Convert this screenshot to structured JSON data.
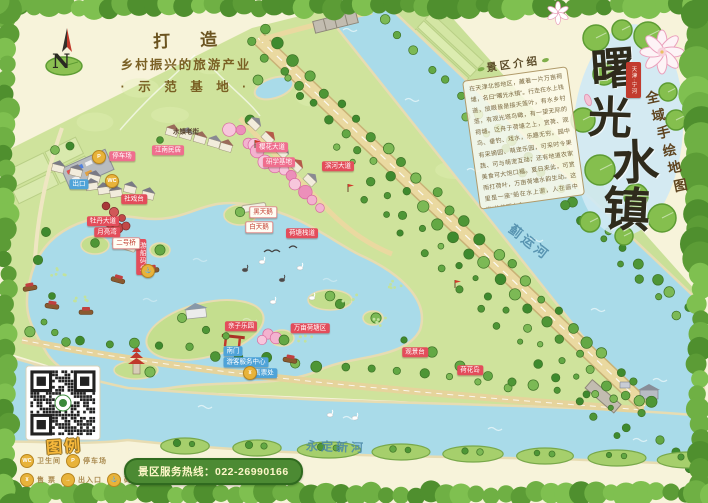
{
  "title": {
    "main": "曙光水镇",
    "seal": "天津·宁河",
    "sub": "全域手绘地图"
  },
  "slogan": {
    "line1": "打 造",
    "line2": "乡村振兴的旅游产业",
    "line3": "· 示 范 基 地 ·"
  },
  "compass": {
    "label": "N"
  },
  "intro": {
    "title": "景区介绍",
    "body": "在天津北部地区，藏着一片万亩荷塘，名曰“曙光水镇”。行走在水上栈道，放眼皆是接天莲叶，有水乡村落，有观光塔鸟瞰，有一望无际的荷塘。泛舟于荷塘之上，赏荷、观鸟、垂钓、戏水，乐趣无穷。园中有采摘园、萌宠乐园，可采时令果蔬、可与萌宠互动；还有地道农家美食可大饱口福。夏日来此，可赏雨打荷叶，万亩荷塘水韵生动。这里是一座“船在水上游，人在画中游”的美丽水乡。"
  },
  "legend": {
    "title": "图例",
    "items": [
      {
        "icon": "toilet-icon",
        "glyph": "WC",
        "label": "卫生间"
      },
      {
        "icon": "parking-icon",
        "glyph": "P",
        "label": "停车场"
      },
      {
        "icon": "ticket-icon",
        "glyph": "¥",
        "label": "售 票"
      },
      {
        "icon": "gate-icon",
        "glyph": "→",
        "label": "出入口"
      },
      {
        "icon": "anchor-icon",
        "glyph": "⚓",
        "label": "码 头"
      }
    ]
  },
  "hotline": {
    "label": "景区服务热线：",
    "number": "022-26990166"
  },
  "rivers": [
    {
      "name": "蓟运河"
    },
    {
      "name": "永定新河"
    }
  ],
  "map_icons": [
    {
      "icon": "parking-icon",
      "glyph": "P",
      "x": 99,
      "y": 157
    },
    {
      "icon": "toilet-icon",
      "glyph": "WC",
      "x": 112,
      "y": 181
    },
    {
      "icon": "anchor-icon",
      "glyph": "⚓",
      "x": 148,
      "y": 271
    },
    {
      "icon": "ticket-icon",
      "glyph": "¥",
      "x": 250,
      "y": 373
    }
  ],
  "pois": [
    {
      "label": "停车场",
      "type": "pink",
      "x": 122,
      "y": 156
    },
    {
      "label": "江南民居",
      "type": "pink",
      "x": 168,
      "y": 150
    },
    {
      "label": "出口",
      "type": "blue",
      "x": 79,
      "y": 184
    },
    {
      "label": "社戏台",
      "type": "red",
      "x": 134,
      "y": 199
    },
    {
      "label": "牡丹大道",
      "type": "red",
      "x": 103,
      "y": 221
    },
    {
      "label": "月亮湾",
      "type": "red",
      "x": 107,
      "y": 232
    },
    {
      "label": "水镇老街",
      "type": "plain",
      "x": 186,
      "y": 132
    },
    {
      "label": "樱花大道",
      "type": "pink",
      "x": 272,
      "y": 147
    },
    {
      "label": "研学基地",
      "type": "pink",
      "x": 279,
      "y": 162
    },
    {
      "label": "滨河大道",
      "type": "red",
      "x": 338,
      "y": 166
    },
    {
      "label": "游船码头",
      "type": "red",
      "x": 141,
      "y": 257,
      "vertical": true
    },
    {
      "label": "二号桥",
      "type": "white",
      "x": 126,
      "y": 243
    },
    {
      "label": "黑天鹅",
      "type": "white",
      "x": 263,
      "y": 212
    },
    {
      "label": "白天鹅",
      "type": "white",
      "x": 259,
      "y": 227
    },
    {
      "label": "荷塘栈道",
      "type": "red",
      "x": 302,
      "y": 233
    },
    {
      "label": "亲子乐园",
      "type": "red",
      "x": 241,
      "y": 326
    },
    {
      "label": "万亩荷塘区",
      "type": "red",
      "x": 310,
      "y": 328
    },
    {
      "label": "南门",
      "type": "blue",
      "x": 233,
      "y": 351
    },
    {
      "label": "游客服务中心",
      "type": "blue",
      "x": 246,
      "y": 362
    },
    {
      "label": "售票处",
      "type": "blue",
      "x": 264,
      "y": 373
    },
    {
      "label": "观景台",
      "type": "red",
      "x": 415,
      "y": 352
    },
    {
      "label": "荷花岛",
      "type": "red",
      "x": 470,
      "y": 370
    }
  ],
  "colors": {
    "border_green": "#6fb044",
    "water": "#a9dbe9",
    "land": "#cfe39c",
    "label_red": "#e34d5b",
    "label_blue": "#4fa3d8",
    "gold": "#8a6a30",
    "hotline_green": "#4c8a33",
    "legend_yellow": "#e8b33a",
    "seal_red": "#c23b2e"
  }
}
